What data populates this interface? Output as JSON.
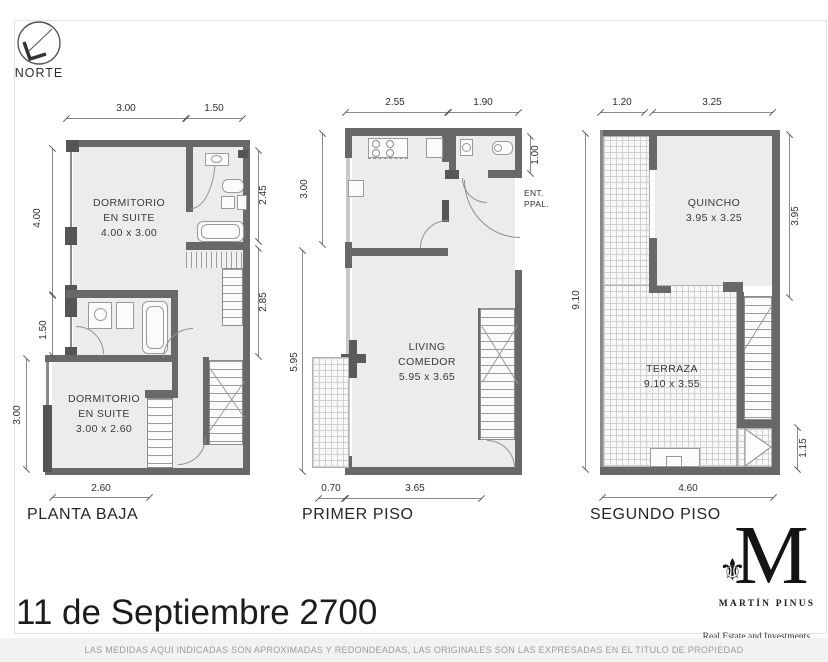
{
  "title": "11 de Septiembre 2700",
  "disclaimer": "LAS MEDIDAS AQUI INDICADAS SON APROXIMADAS Y REDONDEADAS, LAS ORIGINALES SON LAS EXPRESADAS EN EL TITULO DE PROPIEDAD",
  "compass": {
    "label": "NORTE"
  },
  "logo": {
    "monogram": "M",
    "ornament": "⚜",
    "name": "MARTÍN PINUS",
    "tagline": "Real Estate and Investments"
  },
  "colors": {
    "wall": "#686868",
    "floor": "#ececec",
    "dim_text": "#2f2f2f",
    "disclaimer_bg": "#f2f2f2",
    "paper": "#ffffff"
  },
  "plans": [
    {
      "name": "PLANTA BAJA",
      "rooms": [
        {
          "line1": "DORMITORIO",
          "line2": "EN SUITE",
          "size": "4.00 x 3.00"
        },
        {
          "line1": "DORMITORIO",
          "line2": "EN SUITE",
          "size": "3.00 x 2.60"
        }
      ],
      "dims": {
        "top": [
          "3.00",
          "1.50"
        ],
        "left": [
          "4.00",
          "1.50",
          "3.00"
        ],
        "right": [
          "2.45",
          "2.85"
        ],
        "bottom": [
          "2.60"
        ]
      }
    },
    {
      "name": "PRIMER PISO",
      "rooms": [
        {
          "line1": "LIVING",
          "line2": "COMEDOR",
          "size": "5.95 x 3.65"
        }
      ],
      "entrance": {
        "line1": "ENT.",
        "line2": "PPAL."
      },
      "dims": {
        "top": [
          "2.55",
          "1.90"
        ],
        "left": [
          "3.00",
          "5.95"
        ],
        "right": [
          "1.00"
        ],
        "bottom": [
          "0.70",
          "3.65"
        ]
      }
    },
    {
      "name": "SEGUNDO PISO",
      "rooms": [
        {
          "line1": "QUINCHO",
          "size": "3.95 x 3.25"
        },
        {
          "line1": "TERRAZA",
          "size": "9.10 x 3.55"
        }
      ],
      "dims": {
        "top": [
          "1.20",
          "3.25"
        ],
        "left": [
          "9.10"
        ],
        "right": [
          "3.95",
          "1.15"
        ],
        "bottom": [
          "4.60"
        ]
      }
    }
  ]
}
